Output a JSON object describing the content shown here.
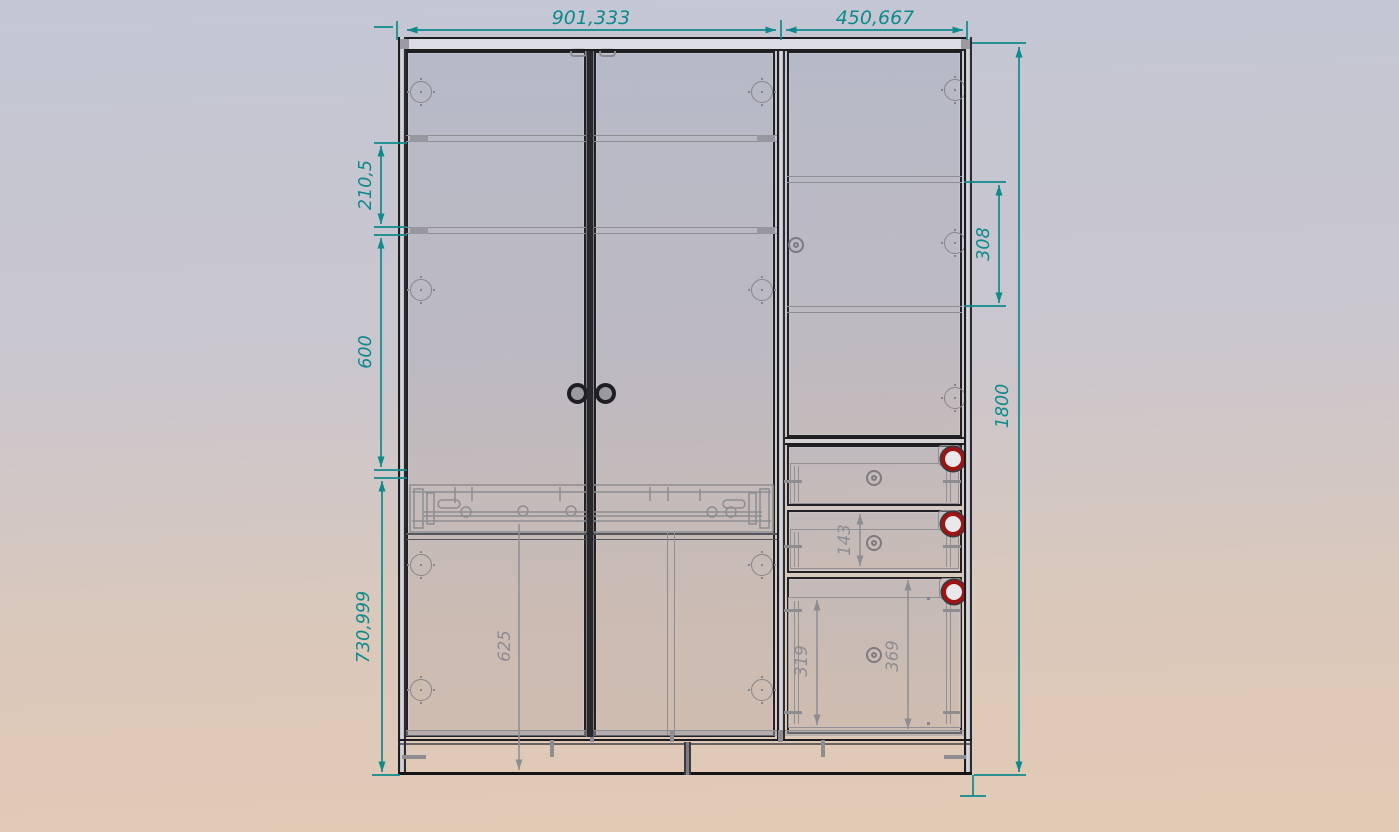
{
  "colors": {
    "dimension": "#0e8a8c",
    "hidden_line": "#8d8d92",
    "outline": "#1e1e22",
    "knob_red": "#9c1414",
    "background_top": "#c3c7d4",
    "background_bottom": "#e3cab4"
  },
  "dimensions": {
    "left_section_width": "901,333",
    "right_section_width": "450,667",
    "upper_shelf_spacing": "210,5",
    "middle_section_height": "600",
    "lower_section_height": "730,999",
    "right_shelf_spacing": "308",
    "overall_height": "1800",
    "drawer_inner_height": "143",
    "bottom_drawer_inner_height": "319",
    "bottom_drawer_front_height": "369",
    "lower_door_height": "625"
  }
}
